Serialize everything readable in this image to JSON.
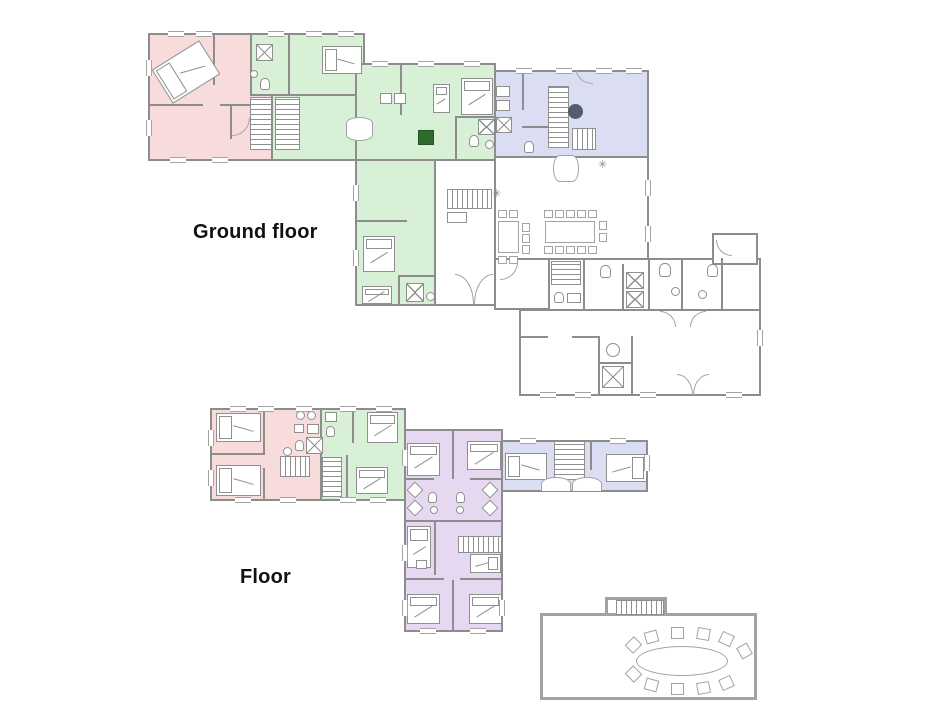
{
  "labels": {
    "ground_floor": "Ground floor",
    "first_floor": "Floor"
  },
  "icons": {
    "vent": "✳"
  },
  "palette": {
    "background": "#ffffff",
    "wall": "#8d8d8d",
    "wall_light": "#a3a3a3",
    "fixture": "#8f8f8f",
    "zone_pink": "#f8dcdc",
    "zone_green": "#d8f0d6",
    "zone_blue": "#dbdef2",
    "zone_purple": "#e7d8f2",
    "stove": "#2e6b2e",
    "marker": "#565b72",
    "label_text": "#111111"
  }
}
